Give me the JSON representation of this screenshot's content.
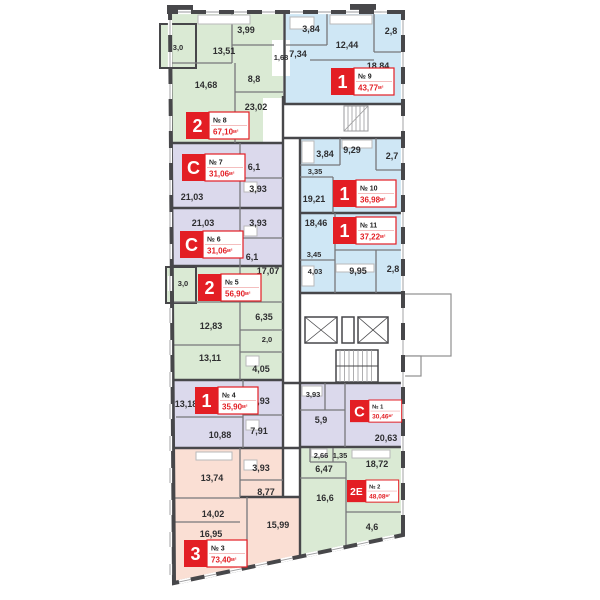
{
  "plan": {
    "apartments": {
      "no1": {
        "type": "С",
        "num": "№ 1",
        "area": "30,46",
        "unit": "м²",
        "rooms": [
          "3,93",
          "5,9",
          "20,63"
        ]
      },
      "no2": {
        "type": "2Е",
        "num": "№ 2",
        "area": "48,08",
        "unit": "м²",
        "rooms": [
          "2,66",
          "1,35",
          "6,47",
          "18,72",
          "16,6",
          "4,6"
        ]
      },
      "no3": {
        "type": "3",
        "num": "№ 3",
        "area": "73,40",
        "unit": "м²",
        "rooms": [
          "3,93",
          "13,74",
          "8,77",
          "14,02",
          "16,95",
          "15,99"
        ]
      },
      "no4": {
        "type": "1",
        "num": "№ 4",
        "area": "35,90",
        "unit": "м²",
        "rooms": [
          "13,18",
          "3,93",
          "10,88",
          "7,91"
        ]
      },
      "no5": {
        "type": "2",
        "num": "№ 5",
        "area": "56,90",
        "unit": "м²",
        "rooms": [
          "17,07",
          "3,0",
          "12,83",
          "6,35",
          "2,0",
          "13,11",
          "4,05"
        ]
      },
      "no6": {
        "type": "С",
        "num": "№ 6",
        "area": "31,06",
        "unit": "м²",
        "rooms": [
          "21,03",
          "3,93",
          "6,1"
        ]
      },
      "no7": {
        "type": "С",
        "num": "№ 7",
        "area": "31,06",
        "unit": "м²",
        "rooms": [
          "6,1",
          "3,93",
          "21,03"
        ]
      },
      "no8": {
        "type": "2",
        "num": "№ 8",
        "area": "67,10",
        "unit": "м²",
        "rooms": [
          "3,0",
          "13,51",
          "3,99",
          "1,68",
          "8,8",
          "14,68",
          "23,02"
        ]
      },
      "no9": {
        "type": "1",
        "num": "№ 9",
        "area": "43,77",
        "unit": "м²",
        "rooms": [
          "3,84",
          "12,44",
          "2,8",
          "7,34",
          "18,84"
        ]
      },
      "no10": {
        "type": "1",
        "num": "№ 10",
        "area": "36,98",
        "unit": "м²",
        "rooms": [
          "3,84",
          "9,29",
          "2,7",
          "3,35",
          "19,21"
        ]
      },
      "no11": {
        "type": "1",
        "num": "№ 11",
        "area": "37,22",
        "unit": "м²",
        "rooms": [
          "18,46",
          "3,45",
          "4,03",
          "9,95",
          "2,8"
        ]
      }
    }
  },
  "colors": {
    "one_room_blue": "#cfe7f5",
    "two_room_green": "#daead4",
    "studio_lavender": "#dbd9ec",
    "three_room_pink": "#fadfd4",
    "badge_red": "#e31e24",
    "wall_dark": "#47474a"
  }
}
